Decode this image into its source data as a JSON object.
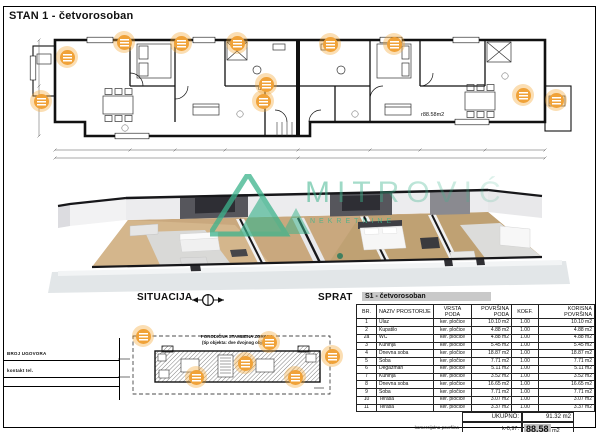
{
  "page": {
    "title": "STAN 1 - četvorosoban"
  },
  "plan": {
    "entrance_label": "ulaz",
    "area_label": "r88.58m2"
  },
  "watermark": {
    "brand": "MITROVIĆ",
    "subtitle": "NEKRETNINE",
    "color": "#3cb38c"
  },
  "bottom": {
    "situacija_label": "SITUACIJA",
    "sprat_label": "SPRAT",
    "contract_label": "BROJ UGOVORA",
    "contact_label": "kontakt tel.",
    "site_text_line1": "PORODIČNA STAMBENA ZGRADA",
    "site_text_line2": "(tip objekta: dve dvojnog objekta)"
  },
  "table": {
    "title": "S1 - četvorosoban",
    "headers": [
      "BR.",
      "NAZIV PROSTORIJE",
      "VRSTA PODA",
      "POVRŠINA PODA",
      "KOEF.",
      "KORISNA POVRŠINA"
    ],
    "rows": [
      [
        "1",
        "Ulaz",
        "ker. pločice",
        "10.10 m2",
        "1.00",
        "10.10 m2"
      ],
      [
        "2",
        "Kupatilo",
        "ker. pločice",
        "4.88 m2",
        "1.00",
        "4.88 m2"
      ],
      [
        "2a",
        "WC",
        "ker. pločice",
        "4.88 m2",
        "1.00",
        "4.88 m2"
      ],
      [
        "3",
        "Kuhinja",
        "ker. pločice",
        "5.45 m2",
        "1.00",
        "5.45 m2"
      ],
      [
        "4",
        "Dnevna soba",
        "ker. pločice",
        "18.87 m2",
        "1.00",
        "18.87 m2"
      ],
      [
        "5",
        "Soba",
        "ker. pločice",
        "7.71 m2",
        "1.00",
        "7.71 m2"
      ],
      [
        "6",
        "Degažman",
        "ker. pločice",
        "5.11 m2",
        "1.00",
        "5.11 m2"
      ],
      [
        "7",
        "Kuhinja",
        "ker. pločice",
        "3.52 m2",
        "1.00",
        "3.52 m2"
      ],
      [
        "8",
        "Dnevna soba",
        "ker. pločice",
        "16.65 m2",
        "1.00",
        "16.65 m2"
      ],
      [
        "9",
        "Soba",
        "ker. pločice",
        "7.71 m2",
        "1.00",
        "7.71 m2"
      ],
      [
        "10",
        "Terasa",
        "ker. pločice",
        "3.07 m2",
        "1.00",
        "3.07 m2"
      ],
      [
        "11",
        "Terasa",
        "ker. pločice",
        "3.37 m2",
        "1.00",
        "3.37 m2"
      ]
    ],
    "total_label": "UKUPNO:",
    "total_value": "91.32 m2",
    "commercial_label": "komercijalna površina",
    "commercial_coef": "k-0,97:",
    "commercial_value": "88.58",
    "commercial_unit": "m2"
  },
  "colors": {
    "marker_orange": "#F0A238",
    "watermark_teal": "#3cb38c",
    "highlight_gray": "#bfbfbf"
  }
}
